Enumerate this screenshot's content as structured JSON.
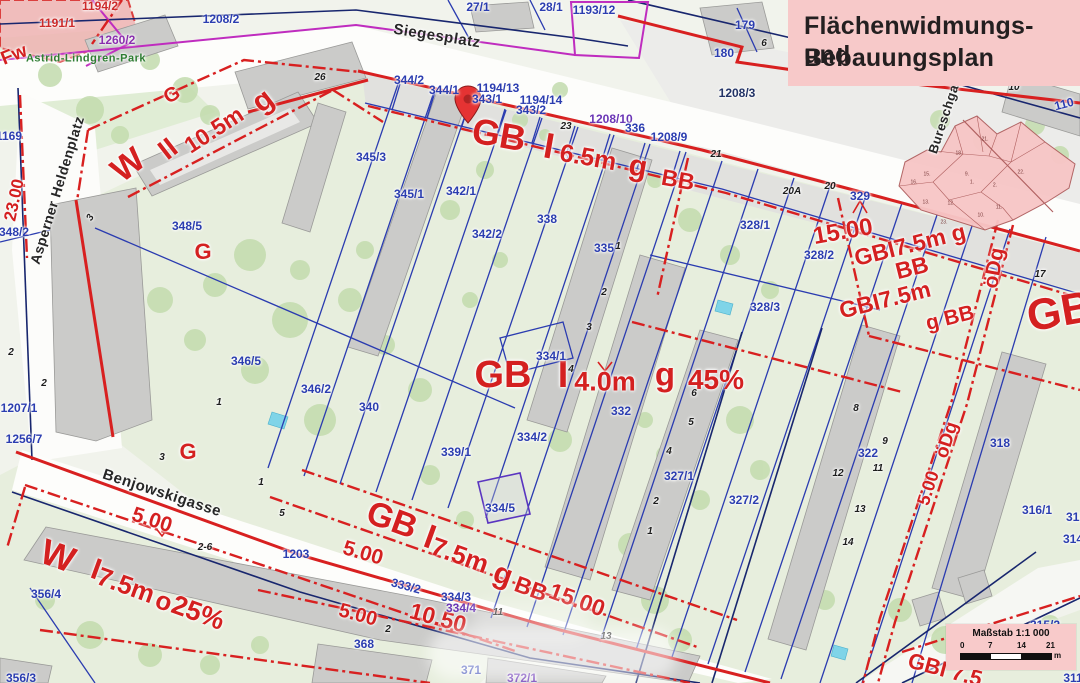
{
  "title_box": {
    "line1": "Flächenwidmungs- und",
    "line2": "Bebauungsplan"
  },
  "scale_box": {
    "title": "Maßstab 1:1 000",
    "ticks": [
      "0",
      "7",
      "14",
      "21"
    ],
    "unit": "m"
  },
  "colors": {
    "zone_red": "#d42020",
    "parcel_blue": "#2b3db0",
    "magenta": "#bf2cbf",
    "pink_box": "#f7c9c9",
    "park_green": "#e6eedd",
    "building_gray": "#cbcbc9",
    "navy": "#18266e",
    "inset_pink": "#f7c6c6"
  },
  "streets": [
    {
      "t": "Siegesplatz",
      "x": 437,
      "y": 36,
      "r": 9
    },
    {
      "t": "Asperner Heldenplatz",
      "x": 57,
      "y": 190,
      "r": -73,
      "s": 14
    },
    {
      "t": "Benjowskigasse",
      "x": 162,
      "y": 493,
      "r": 18
    },
    {
      "t": "Bureschgasse",
      "x": 947,
      "y": 108,
      "r": -72,
      "s": 13
    },
    {
      "t": "Astrid-Lindgren-Park",
      "x": 86,
      "y": 59,
      "r": 0,
      "s": 11,
      "c": "#2e7d32"
    }
  ],
  "zone_labels": [
    {
      "t": "G",
      "x": 172,
      "y": 95,
      "r": -30,
      "s": 20
    },
    {
      "t": "W",
      "x": 128,
      "y": 165,
      "r": -38,
      "s": 34
    },
    {
      "t": "II",
      "x": 168,
      "y": 149,
      "r": -38,
      "s": 28
    },
    {
      "t": "10.5m",
      "x": 214,
      "y": 130,
      "r": -33,
      "s": 23
    },
    {
      "t": "g",
      "x": 263,
      "y": 101,
      "r": -38,
      "s": 30
    },
    {
      "t": "G",
      "x": 203,
      "y": 252,
      "r": 0,
      "s": 22
    },
    {
      "t": "G",
      "x": 188,
      "y": 452,
      "r": 0,
      "s": 22
    },
    {
      "t": "GB",
      "x": 499,
      "y": 135,
      "r": 10,
      "s": 36
    },
    {
      "t": "I",
      "x": 549,
      "y": 146,
      "r": 10,
      "s": 36
    },
    {
      "t": "6.5m",
      "x": 588,
      "y": 158,
      "r": 10,
      "s": 25
    },
    {
      "t": "g",
      "x": 638,
      "y": 167,
      "r": 10,
      "s": 30
    },
    {
      "t": "BB",
      "x": 678,
      "y": 180,
      "r": 10,
      "s": 23
    },
    {
      "t": "GB",
      "x": 503,
      "y": 375,
      "r": 0,
      "s": 38
    },
    {
      "t": "I",
      "x": 563,
      "y": 375,
      "r": 0,
      "s": 38
    },
    {
      "t": "4.0m",
      "x": 605,
      "y": 382,
      "r": 0,
      "s": 27
    },
    {
      "t": "g",
      "x": 665,
      "y": 374,
      "r": 0,
      "s": 33
    },
    {
      "t": "45%",
      "x": 716,
      "y": 380,
      "r": 0,
      "s": 28
    },
    {
      "t": "GBI7.5m g",
      "x": 910,
      "y": 245,
      "r": -14,
      "s": 23
    },
    {
      "t": "BB",
      "x": 912,
      "y": 268,
      "r": -14,
      "s": 23
    },
    {
      "t": "GBI7.5m",
      "x": 885,
      "y": 300,
      "r": -14,
      "s": 23
    },
    {
      "t": "g BB",
      "x": 950,
      "y": 318,
      "r": -14,
      "s": 21
    },
    {
      "t": "GB",
      "x": 1060,
      "y": 312,
      "r": -10,
      "s": 44
    },
    {
      "t": "W",
      "x": 58,
      "y": 556,
      "r": 20,
      "s": 36
    },
    {
      "t": "I",
      "x": 96,
      "y": 570,
      "r": 20,
      "s": 30
    },
    {
      "t": "7.5m",
      "x": 126,
      "y": 585,
      "r": 20,
      "s": 26
    },
    {
      "t": "o",
      "x": 164,
      "y": 601,
      "r": 20,
      "s": 26
    },
    {
      "t": "25%",
      "x": 198,
      "y": 613,
      "r": 20,
      "s": 27
    },
    {
      "t": "GB",
      "x": 392,
      "y": 520,
      "r": 20,
      "s": 34
    },
    {
      "t": "I",
      "x": 430,
      "y": 537,
      "r": 20,
      "s": 34
    },
    {
      "t": "7.5m",
      "x": 460,
      "y": 555,
      "r": 20,
      "s": 26
    },
    {
      "t": "g",
      "x": 503,
      "y": 575,
      "r": 20,
      "s": 30
    },
    {
      "t": "BB",
      "x": 531,
      "y": 589,
      "r": 20,
      "s": 23
    },
    {
      "t": "GBI 7.5",
      "x": 945,
      "y": 670,
      "r": 15,
      "s": 22
    }
  ],
  "dim_labels": [
    {
      "t": "Fw",
      "x": 14,
      "y": 55,
      "r": -22,
      "s": 19
    },
    {
      "t": "23.00",
      "x": 14,
      "y": 200,
      "r": -78,
      "s": 17
    },
    {
      "t": "15.00",
      "x": 843,
      "y": 232,
      "r": -10,
      "s": 24
    },
    {
      "t": "öDg",
      "x": 994,
      "y": 268,
      "r": -80,
      "s": 21
    },
    {
      "t": "15.00",
      "x": 577,
      "y": 600,
      "r": 20,
      "s": 23
    },
    {
      "t": "5.00",
      "x": 152,
      "y": 520,
      "r": 18,
      "s": 21
    },
    {
      "t": "5.00",
      "x": 363,
      "y": 553,
      "r": 16,
      "s": 21
    },
    {
      "t": "5.00",
      "x": 358,
      "y": 615,
      "r": 15,
      "s": 20
    },
    {
      "t": "10.50",
      "x": 438,
      "y": 618,
      "r": 15,
      "s": 23
    },
    {
      "t": "öDg",
      "x": 947,
      "y": 440,
      "r": -72,
      "s": 19
    },
    {
      "t": "5.00",
      "x": 928,
      "y": 488,
      "r": -72,
      "s": 18
    }
  ],
  "parcel_labels": [
    {
      "t": "1194/2",
      "x": 100,
      "y": 6,
      "c": "#cc2a2a"
    },
    {
      "t": "1191/1",
      "x": 57,
      "y": 23,
      "c": "#cc2a2a"
    },
    {
      "t": "1260/2",
      "x": 117,
      "y": 40,
      "c": "#8a2fae"
    },
    {
      "t": "1208/2",
      "x": 221,
      "y": 19
    },
    {
      "t": "27/1",
      "x": 478,
      "y": 7
    },
    {
      "t": "28/1",
      "x": 551,
      "y": 7
    },
    {
      "t": "1193/12",
      "x": 594,
      "y": 10
    },
    {
      "t": "182",
      "x": 925,
      "y": 15
    },
    {
      "t": "179",
      "x": 745,
      "y": 25
    },
    {
      "t": "180",
      "x": 724,
      "y": 53
    },
    {
      "t": "1208/3",
      "x": 737,
      "y": 93,
      "c": "#223366"
    },
    {
      "t": "110",
      "x": 1064,
      "y": 104,
      "r": -15
    },
    {
      "t": "1169",
      "x": 9,
      "y": 136
    },
    {
      "t": "344/2",
      "x": 409,
      "y": 80
    },
    {
      "t": "344/1",
      "x": 444,
      "y": 90
    },
    {
      "t": "1194/13",
      "x": 498,
      "y": 88
    },
    {
      "t": "343/1",
      "x": 487,
      "y": 99
    },
    {
      "t": "1194/14",
      "x": 541,
      "y": 100
    },
    {
      "t": "343/2",
      "x": 531,
      "y": 110
    },
    {
      "t": "1208/10",
      "x": 611,
      "y": 119,
      "c": "#6a35b5"
    },
    {
      "t": "336",
      "x": 635,
      "y": 128
    },
    {
      "t": "1208/9",
      "x": 669,
      "y": 137
    },
    {
      "t": "329",
      "x": 860,
      "y": 196
    },
    {
      "t": "328/1",
      "x": 755,
      "y": 225
    },
    {
      "t": "328/2",
      "x": 819,
      "y": 255
    },
    {
      "t": "328/3",
      "x": 765,
      "y": 307
    },
    {
      "t": "345/3",
      "x": 371,
      "y": 157
    },
    {
      "t": "345/1",
      "x": 409,
      "y": 194
    },
    {
      "t": "342/1",
      "x": 461,
      "y": 191
    },
    {
      "t": "342/2",
      "x": 487,
      "y": 234
    },
    {
      "t": "338",
      "x": 547,
      "y": 219
    },
    {
      "t": "335",
      "x": 604,
      "y": 248
    },
    {
      "t": "334/1",
      "x": 551,
      "y": 356
    },
    {
      "t": "334/2",
      "x": 532,
      "y": 437
    },
    {
      "t": "334/5",
      "x": 500,
      "y": 508
    },
    {
      "t": "332",
      "x": 621,
      "y": 411
    },
    {
      "t": "327/1",
      "x": 679,
      "y": 476
    },
    {
      "t": "327/2",
      "x": 744,
      "y": 500
    },
    {
      "t": "322",
      "x": 868,
      "y": 453
    },
    {
      "t": "318",
      "x": 1000,
      "y": 443
    },
    {
      "t": "316/1",
      "x": 1037,
      "y": 510
    },
    {
      "t": "312",
      "x": 1076,
      "y": 517
    },
    {
      "t": "314",
      "x": 1073,
      "y": 539
    },
    {
      "t": "315/2",
      "x": 1045,
      "y": 625
    },
    {
      "t": "311",
      "x": 1073,
      "y": 678
    },
    {
      "t": "348/2",
      "x": 14,
      "y": 232
    },
    {
      "t": "348/5",
      "x": 187,
      "y": 226
    },
    {
      "t": "346/5",
      "x": 246,
      "y": 361
    },
    {
      "t": "346/2",
      "x": 316,
      "y": 389
    },
    {
      "t": "340",
      "x": 369,
      "y": 407
    },
    {
      "t": "339/1",
      "x": 456,
      "y": 452
    },
    {
      "t": "1207/1",
      "x": 19,
      "y": 408
    },
    {
      "t": "1256/7",
      "x": 24,
      "y": 439
    },
    {
      "t": "356/4",
      "x": 46,
      "y": 594
    },
    {
      "t": "356/3",
      "x": 21,
      "y": 678
    },
    {
      "t": "1203",
      "x": 296,
      "y": 554
    },
    {
      "t": "368",
      "x": 364,
      "y": 644
    },
    {
      "t": "371",
      "x": 471,
      "y": 670
    },
    {
      "t": "372/1",
      "x": 522,
      "y": 678,
      "c": "#6a35b5"
    },
    {
      "t": "333/2",
      "x": 406,
      "y": 586,
      "r": 15
    },
    {
      "t": "334/3",
      "x": 456,
      "y": 597
    },
    {
      "t": "334/4",
      "x": 461,
      "y": 608,
      "c": "#6a35b5"
    }
  ],
  "house_numbers": [
    {
      "t": "26",
      "x": 320,
      "y": 78
    },
    {
      "t": "5",
      "x": 942,
      "y": 23
    },
    {
      "t": "6",
      "x": 764,
      "y": 44
    },
    {
      "t": "10",
      "x": 1014,
      "y": 88
    },
    {
      "t": "23",
      "x": 566,
      "y": 127
    },
    {
      "t": "21",
      "x": 716,
      "y": 155
    },
    {
      "t": "20A",
      "x": 792,
      "y": 192
    },
    {
      "t": "20",
      "x": 830,
      "y": 187
    },
    {
      "t": "17",
      "x": 1040,
      "y": 275
    },
    {
      "t": "3",
      "x": 91,
      "y": 218,
      "r": -60
    },
    {
      "t": "3",
      "x": 162,
      "y": 458
    },
    {
      "t": "1",
      "x": 261,
      "y": 483
    },
    {
      "t": "5",
      "x": 282,
      "y": 514
    },
    {
      "t": "2-6",
      "x": 205,
      "y": 548
    },
    {
      "t": "2",
      "x": 388,
      "y": 630
    },
    {
      "t": "11",
      "x": 498,
      "y": 613
    },
    {
      "t": "13",
      "x": 606,
      "y": 637
    },
    {
      "t": "1",
      "x": 618,
      "y": 247
    },
    {
      "t": "2",
      "x": 604,
      "y": 293
    },
    {
      "t": "3",
      "x": 589,
      "y": 328
    },
    {
      "t": "4",
      "x": 571,
      "y": 370
    },
    {
      "t": "1",
      "x": 650,
      "y": 532
    },
    {
      "t": "2",
      "x": 656,
      "y": 502
    },
    {
      "t": "4",
      "x": 669,
      "y": 452
    },
    {
      "t": "5",
      "x": 691,
      "y": 423
    },
    {
      "t": "6",
      "x": 694,
      "y": 394
    },
    {
      "t": "8",
      "x": 856,
      "y": 409
    },
    {
      "t": "9",
      "x": 885,
      "y": 442
    },
    {
      "t": "11",
      "x": 878,
      "y": 469
    },
    {
      "t": "12",
      "x": 838,
      "y": 474
    },
    {
      "t": "13",
      "x": 860,
      "y": 510
    },
    {
      "t": "14",
      "x": 848,
      "y": 543
    },
    {
      "t": "1",
      "x": 219,
      "y": 403
    },
    {
      "t": "2",
      "x": 11,
      "y": 353
    },
    {
      "t": "2",
      "x": 44,
      "y": 384
    }
  ],
  "inset_districts": [
    {
      "t": "21.",
      "x": 985,
      "y": 140
    },
    {
      "t": "22.",
      "x": 1021,
      "y": 173
    },
    {
      "t": "2.",
      "x": 995,
      "y": 186
    },
    {
      "t": "10.",
      "x": 981,
      "y": 216
    },
    {
      "t": "11.",
      "x": 999,
      "y": 208
    },
    {
      "t": "23.",
      "x": 944,
      "y": 223
    },
    {
      "t": "13.",
      "x": 926,
      "y": 203
    },
    {
      "t": "16.",
      "x": 914,
      "y": 183
    },
    {
      "t": "15.",
      "x": 927,
      "y": 175
    },
    {
      "t": "12.",
      "x": 951,
      "y": 204
    },
    {
      "t": "9.",
      "x": 967,
      "y": 175
    },
    {
      "t": "18.",
      "x": 959,
      "y": 154
    },
    {
      "t": "1.",
      "x": 972,
      "y": 183
    }
  ]
}
